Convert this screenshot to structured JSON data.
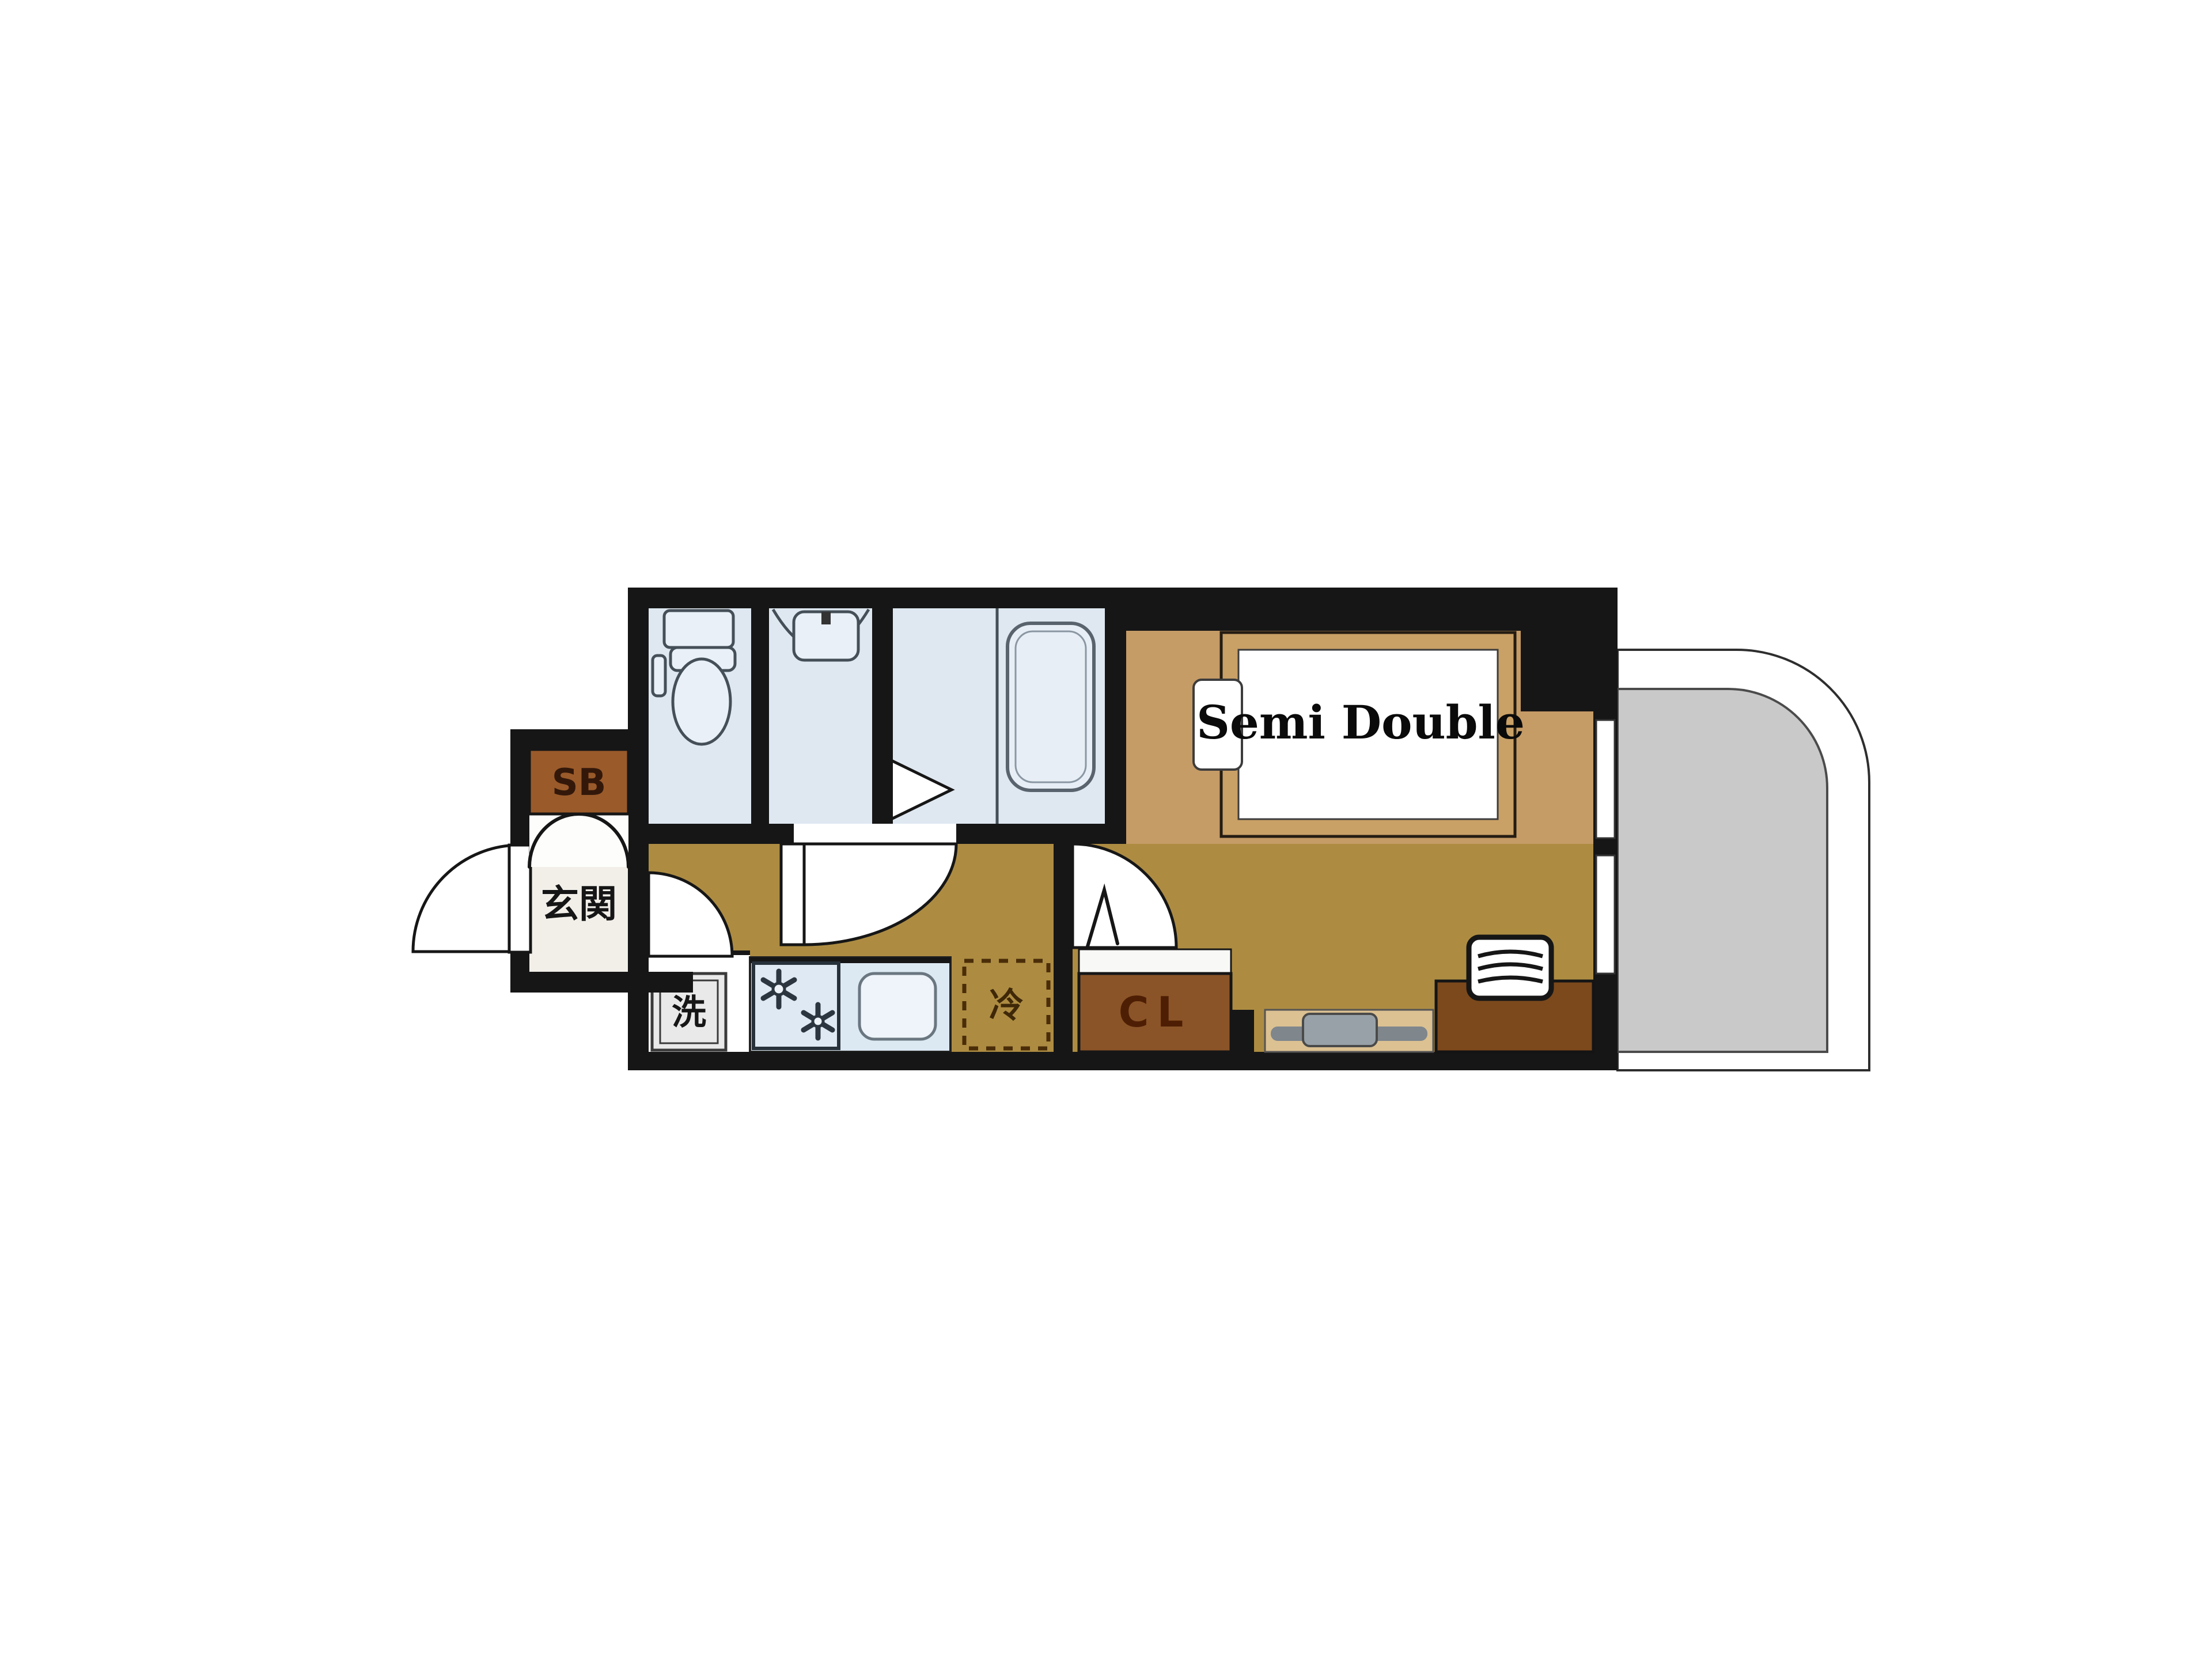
{
  "plan": {
    "type": "apartment-floor-plan",
    "labels": {
      "shoebox": "SB",
      "entrance": "玄関",
      "washer": "洗",
      "fridge": "冷",
      "closet": "CL",
      "bed": "Semi Double"
    },
    "colors": {
      "wall": "#161616",
      "corridor_floor": "#ad8c42",
      "bedroom_floor": "#c59b66",
      "wet_area_floor": "#dfe8f1",
      "closet_brown": "#8a5428",
      "shoebox_brown": "#9a5a2a",
      "desk_brown": "#7c491c",
      "bed_frame": "#c9a066",
      "balcony_gray": "#c9c9c9",
      "kitchen_counter": "#dce8f2",
      "tv_board": "#dcc192"
    }
  }
}
